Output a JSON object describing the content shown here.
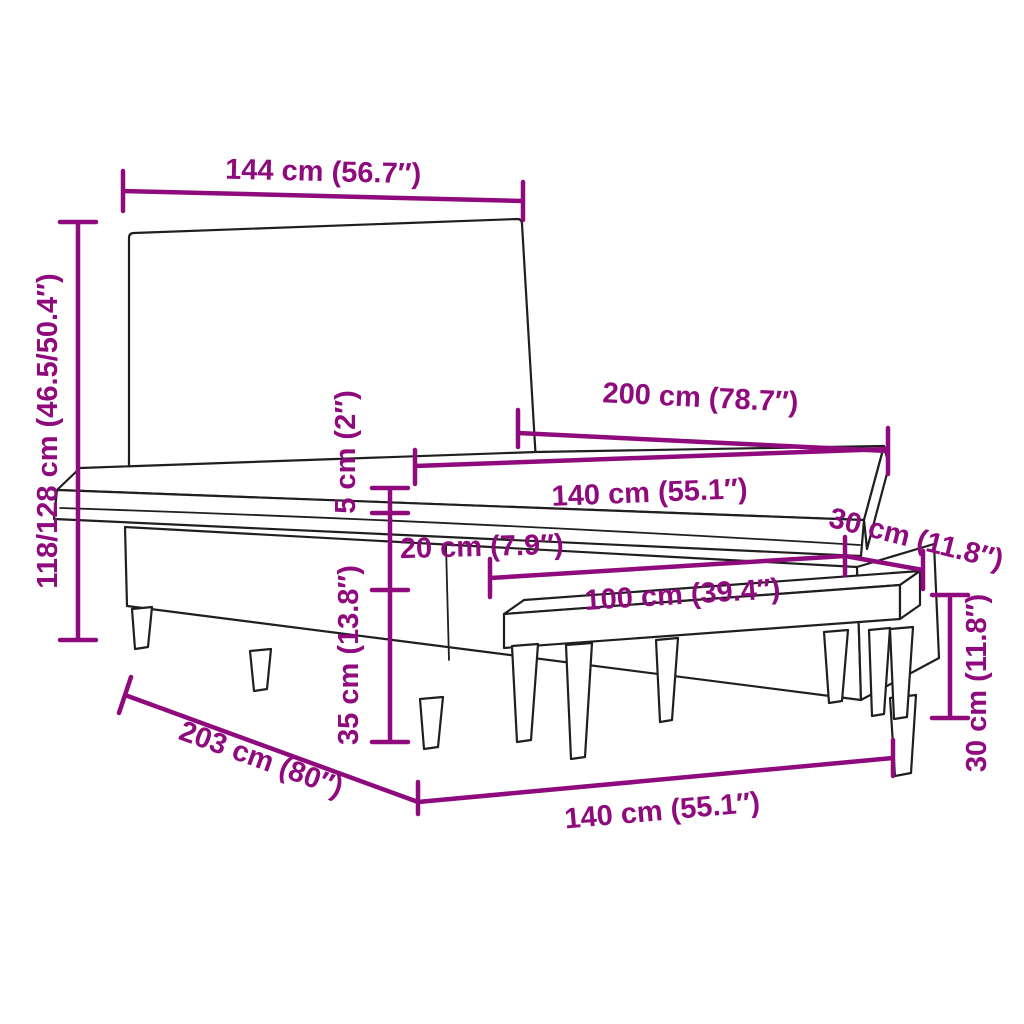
{
  "title": "Box spring bed with tufted headboard and bench — dimensions diagram",
  "colors": {
    "dimension_accent": "#8F0B7D",
    "outline": "#1F1F1F",
    "background": "#FFFFFF"
  },
  "dims": {
    "headboard_width": "144 cm (56.7″)",
    "total_height": "118/128 cm (46.5/50.4″)",
    "bed_length": "200 cm (78.7″)",
    "mattress_width": "140 cm (55.1″)",
    "topper_thickness": "5 cm (2″)",
    "mattress_thickness": "20 cm (7.9″)",
    "base_height": "35 cm (13.8″)",
    "bench_length": "100 cm (39.4″)",
    "bench_depth": "30 cm (11.8″)",
    "bench_height": "30 cm (11.8″)",
    "frame_length": "203 cm (80″)",
    "frame_width": "140 cm (55.1″)"
  }
}
